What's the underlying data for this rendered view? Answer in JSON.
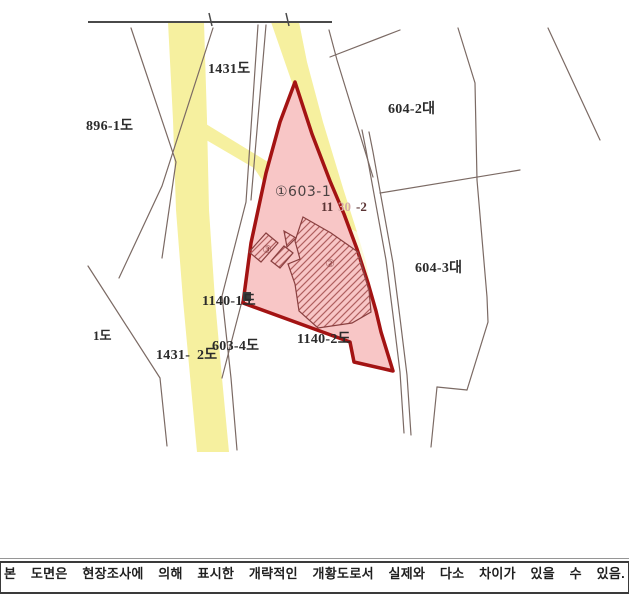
{
  "map": {
    "labels": {
      "p1431": "1431도",
      "p604_2": "604-2대",
      "p896_1": "896-1도",
      "p603_1": "①603-1",
      "p1130_a": "11",
      "p1130_b": "30",
      "p1130_c": "-2",
      "mark2": "②",
      "mark3": "③",
      "p604_3": "604-3대",
      "p1140_1": "1140-1도",
      "p603_4": "603-4도",
      "p1140_2": "1140-2도",
      "p1431_2a": "1431-",
      "p1431_2b": "2도",
      "p1_do": "1도"
    },
    "colors": {
      "road": "#f6f09f",
      "road_pale": "#faf6c4",
      "parcel_fill": "#f8c6c6",
      "parcel_stroke": "#a31313",
      "boundary": "#7b6a64",
      "frame": "#4a4a4a",
      "hatch_edge": "#8a4040",
      "hatch_line": "#b06060",
      "roadnum_dark": "#5b3434",
      "roadnum_faint": "#d4a8a8",
      "label_on_road": "#a9a294"
    }
  },
  "footer": {
    "note": "본 도면은 현장조사에 의해 표시한 개략적인 개황도로서 실제와 다소 차이가 있을 수 있음."
  }
}
